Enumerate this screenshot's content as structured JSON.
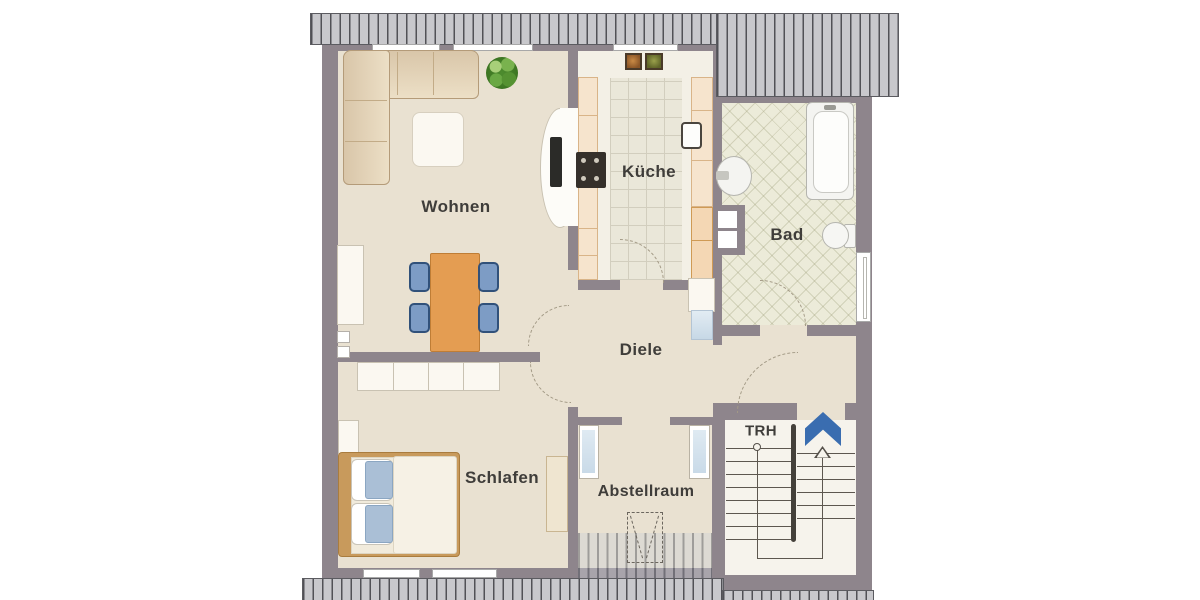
{
  "rooms": {
    "wohnen": {
      "label": "Wohnen"
    },
    "kueche": {
      "label": "Küche"
    },
    "bad": {
      "label": "Bad"
    },
    "diele": {
      "label": "Diele"
    },
    "schlafen": {
      "label": "Schlafen"
    },
    "abstellraum": {
      "label": "Abstellraum"
    },
    "trh": {
      "label": "TRH"
    }
  },
  "stairwell": {
    "direction": "up",
    "arrow_icon": "up-chevron"
  },
  "colors": {
    "wall": "#8e858c",
    "floor": "#e9e1d1",
    "kitchen_floor": "#f3f0e6",
    "bath_floor": "#ecebd9",
    "stair_floor": "#f6f3ec",
    "roof_hatch": "#c8c8cc",
    "accent_blue": "#3a6db0",
    "wood_orange": "#e49d52",
    "chair_blue": "#7d9cc5",
    "sofa_beige": "#e7d7bb"
  }
}
